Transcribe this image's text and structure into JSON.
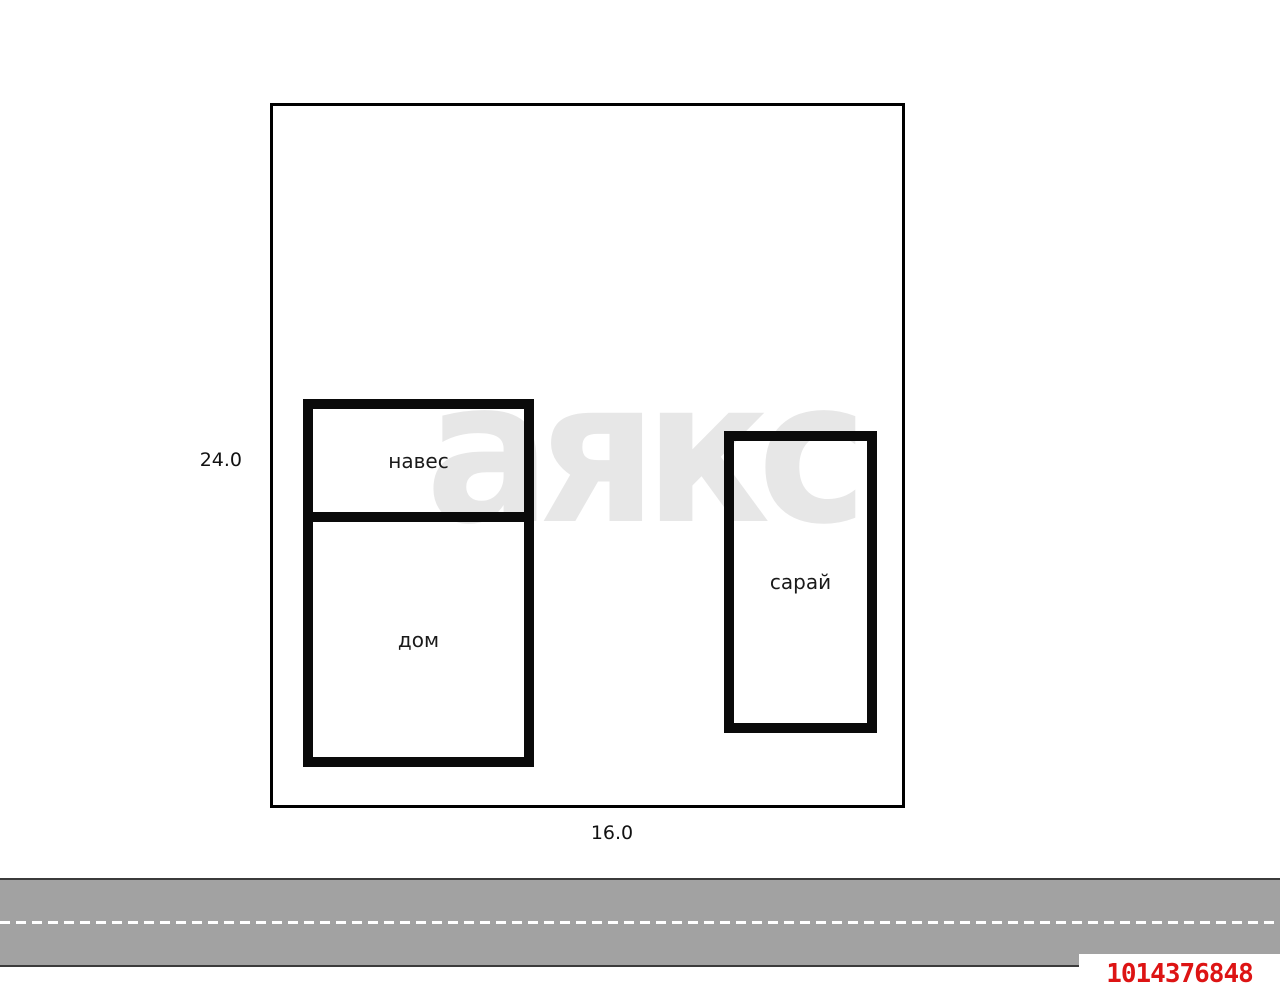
{
  "watermark_text": "аякс",
  "dimensions": {
    "height_label": "24.0",
    "width_label": "16.0"
  },
  "buildings": {
    "canopy_label": "навес",
    "house_label": "дом",
    "barn_label": "сарай"
  },
  "listing_id": "1014376848",
  "colors": {
    "wall": "#0a0a0a",
    "plot_border": "#000000",
    "watermark": "#e7e7e7",
    "road_fill": "#a2a2a2",
    "road_border": "#3b3b3b",
    "road_dash": "#ffffff",
    "listing_id_red": "#dd1414"
  }
}
